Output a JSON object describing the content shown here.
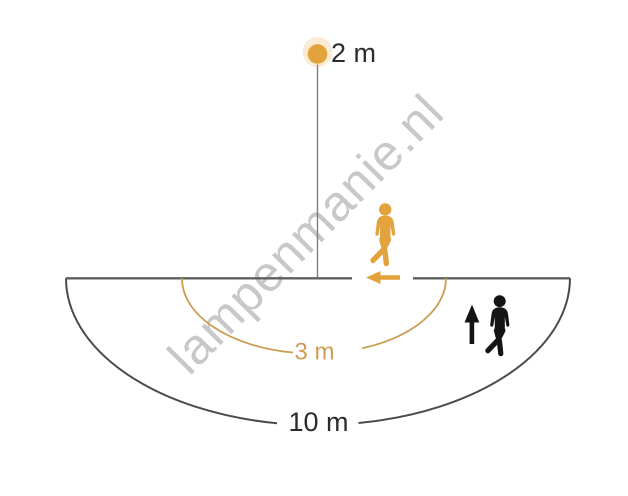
{
  "diagram": {
    "watermark": "lampenmanie.nl",
    "sensor": {
      "mounting_height_label": "2 m"
    },
    "ranges": {
      "tangential_label": "3 m",
      "radial_label": "10 m"
    },
    "colors": {
      "orange": "#E3A33C",
      "orange-soft": "#CC9E55",
      "ink": "#2B2B2B",
      "icon-dark": "#141414",
      "arc-dark": "#4B4B4B",
      "line-gray": "#5F5F5F",
      "stem-gray": "#7E7E7E",
      "watermark-gray": "#C8C8C8"
    }
  }
}
